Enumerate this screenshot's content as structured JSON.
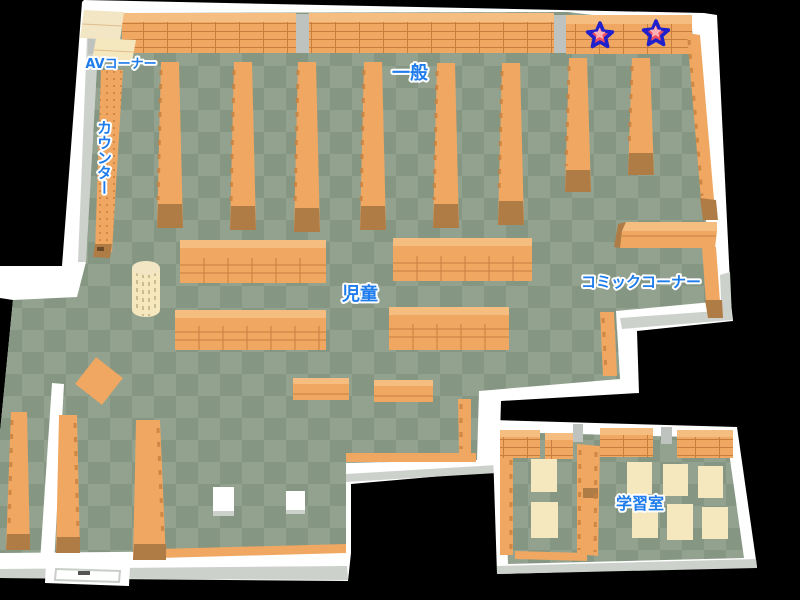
{
  "map": {
    "labels": {
      "av_corner": "AVコーナー",
      "counter": "カウンター",
      "general": "一般",
      "children": "児童",
      "comic_corner": "コミックコーナー",
      "study_room": "学習室"
    },
    "markers": [
      {
        "id": "star-marker-1",
        "x": 600,
        "y": 36
      },
      {
        "id": "star-marker-2",
        "x": 656,
        "y": 34
      }
    ],
    "colors": {
      "background": "#000000",
      "wall": "#FFFFFF",
      "wall_shade": "#CDD1CC",
      "floor_light": "#93A28F",
      "floor_dark": "#859683",
      "shelf": "#EFA761",
      "shelf_top": "#F5BD80",
      "shelf_dark": "#C67F3F",
      "shelf_base": "#B07C46",
      "desk": "#F5E7BE",
      "label_blue": "#1E7CEC",
      "star_red": "#F0505E",
      "star_blue": "#2020CC",
      "star_pink": "#FFB0B4"
    }
  }
}
